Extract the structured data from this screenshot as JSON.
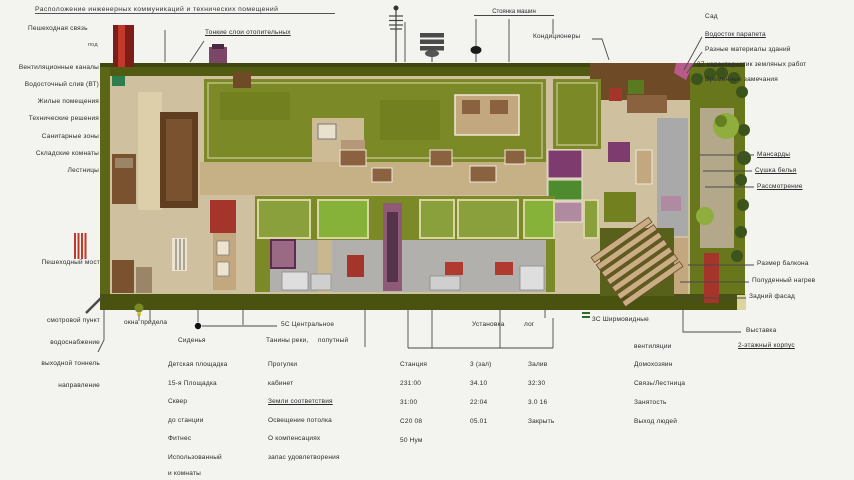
{
  "palette": {
    "background": "#f3f3f0",
    "site_green_dark": "#4f5a14",
    "roof_green": "#7b8a26",
    "floor_beige": "#cfc0a0",
    "wall_brown": "#6e4a26",
    "accent_red": "#a5342a",
    "corridor_gray": "#a9a9a9",
    "mauve": "#8e5a78",
    "label_text": "#2a2a2a"
  },
  "icons": {
    "antenna-icon": "pole with crossbars",
    "ac-unit-icon": "striped box ≡",
    "street-lamp-icon": "pole with black head",
    "survey-marker-icon": "● filled dot",
    "red-grate-icon": "||| red vertical bars",
    "tree-lamp-icon": "small green bulb"
  },
  "header": {
    "title": "Расположение инженерных коммуникаций и технических помещений",
    "pedestrian": "Пешеходная связь",
    "pod": "под",
    "heating": "Тонкие слои отопительных",
    "parking": "Стоянка машин",
    "ac": "Кондиционеры",
    "right_group": [
      "Сад",
      "Водосток парапета",
      "Разные материалы зданий",
      "37 характеристик земляных работ",
      "Временные замечания"
    ]
  },
  "left_labels": [
    "Вентиляционные каналы",
    "Водосточный слив (ВТ)",
    "Жилые помещения",
    "Технические решения",
    "Санитарные зоны",
    "Складские комнаты",
    "Лестницы"
  ],
  "left_lower": {
    "bridge": "Пешеходный мост"
  },
  "right_labels": {
    "upper": [
      "Мансарды",
      "Сушка белья",
      "Рассмотрение"
    ],
    "lower": [
      "Размер балкона",
      "Полуденный нагрев",
      "Задний фасад"
    ],
    "bottom": [
      "Выставка",
      "2-этажный корпус"
    ]
  },
  "bottom": {
    "left_col": [
      "смотровой пункт",
      "водоснабжение",
      "выходной тоннель",
      "направление"
    ],
    "okna": "окна придела",
    "marker5c": "5С Центральное",
    "seats": "Сиденья",
    "tanin": "Танины реки,",
    "poputny": "попутный",
    "colA": [
      "Детская площадка",
      "15-я Площадка",
      "Сквер",
      "до станции",
      "Фитнес",
      "Использованный",
      "и комнаты"
    ],
    "colB": [
      "Прогулки",
      "кабинет",
      "Земли соответствия",
      "Освещение потолка",
      "О компенсациях",
      "запас удовлетворения"
    ],
    "bracket": {
      "ustanovka": "Установка",
      "log": "лог"
    },
    "marker3c": "3С Ширмовидные",
    "table": {
      "col1": [
        "Станция",
        "231:00",
        "31:00",
        "С20 08",
        "50 Нум"
      ],
      "col2": [
        "3 (зал)",
        "34.10",
        "22:04",
        "05.01"
      ],
      "col3": [
        "Залив",
        "32:30",
        "3.0 16",
        "Закрыть"
      ],
      "col4_header": "вентиляции",
      "col4": [
        "Домохозяин",
        "Связь/Лестница",
        "Занятость",
        "Выход людей"
      ]
    }
  }
}
